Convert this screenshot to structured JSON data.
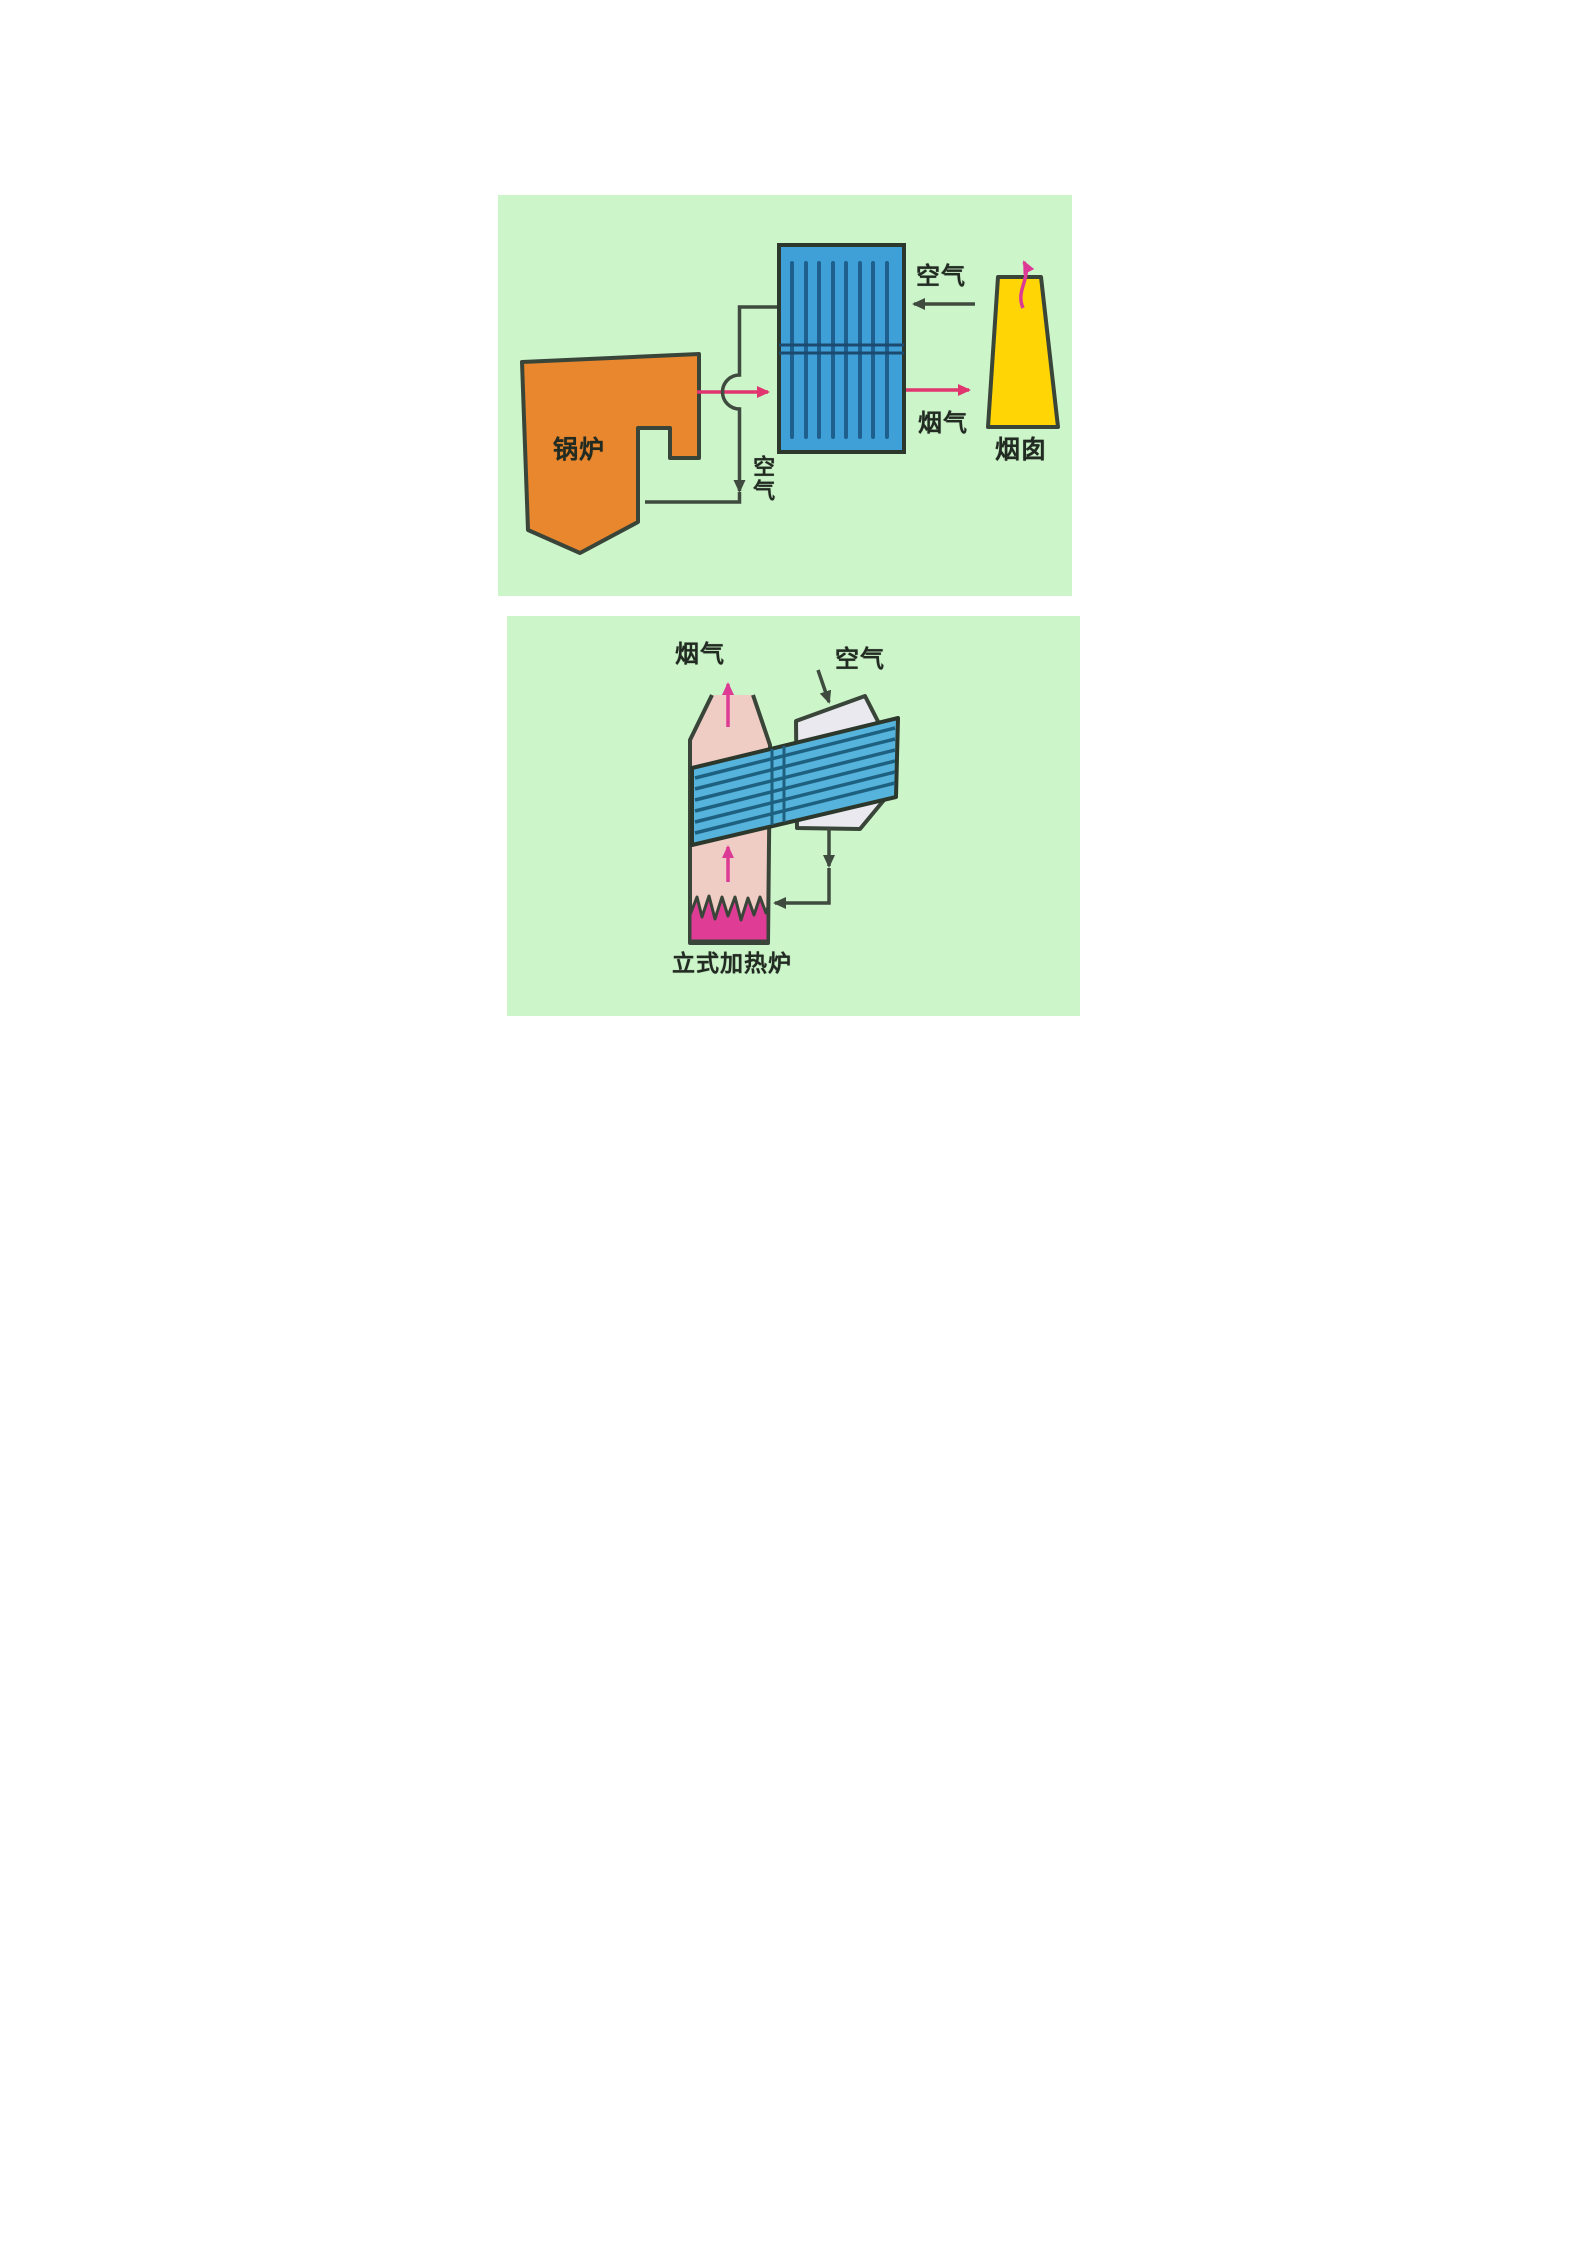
{
  "panel1": {
    "labels": {
      "boiler": "锅炉",
      "air_top": "空气",
      "flue_gas": "烟气",
      "chimney": "烟囱",
      "air_bottom": "空气"
    }
  },
  "panel2": {
    "labels": {
      "flue_gas": "烟气",
      "air": "空气",
      "furnace": "立式加热炉"
    }
  },
  "colors": {
    "panel_background": "#cdf5ca",
    "boiler_orange": "#e8872e",
    "exchanger_blue": "#3fa0d8",
    "tube_line_blue": "#1e5f8e",
    "chimney_yellow": "#ffd506",
    "band_blue": "#55b3dc",
    "band_line_blue": "#1e6080",
    "furnace_salmon": "#efccc4",
    "flame_magenta": "#df3d95",
    "duct_gray": "#e9e9ef",
    "flue_arrow_pink": "#e0356e",
    "smoke_arrow_magenta": "#dd3a95",
    "pipe_line_dark": "#3e4b3e",
    "outline_dark": "#3a453a",
    "text_dark": "#222b22"
  }
}
